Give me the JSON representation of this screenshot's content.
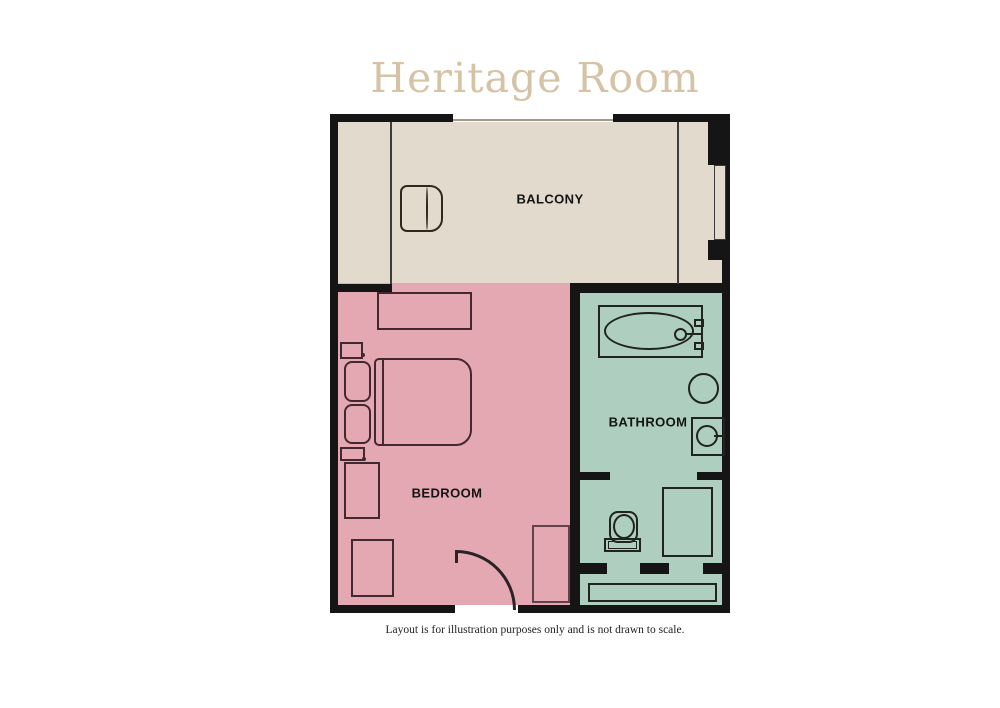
{
  "title": "Heritage Room",
  "caption": "Layout is for illustration purposes only and is not drawn to scale.",
  "rooms": {
    "balcony": {
      "label": "BALCONY"
    },
    "bedroom": {
      "label": "BEDROOM"
    },
    "bathroom": {
      "label": "BATHROOM"
    }
  },
  "colors": {
    "balcony": "#e2dbcd",
    "bedroom": "#e3a8b1",
    "bathroom": "#aecec0",
    "wall": "#151515",
    "title": "#d6c3a6"
  },
  "fixtures": [
    "armchair",
    "console-table",
    "nightstand",
    "pillow",
    "double-bed",
    "side-table",
    "bench",
    "wardrobe",
    "door-swing",
    "window",
    "bathtub",
    "stool",
    "vanity-sink",
    "toilet",
    "shower",
    "closet"
  ]
}
